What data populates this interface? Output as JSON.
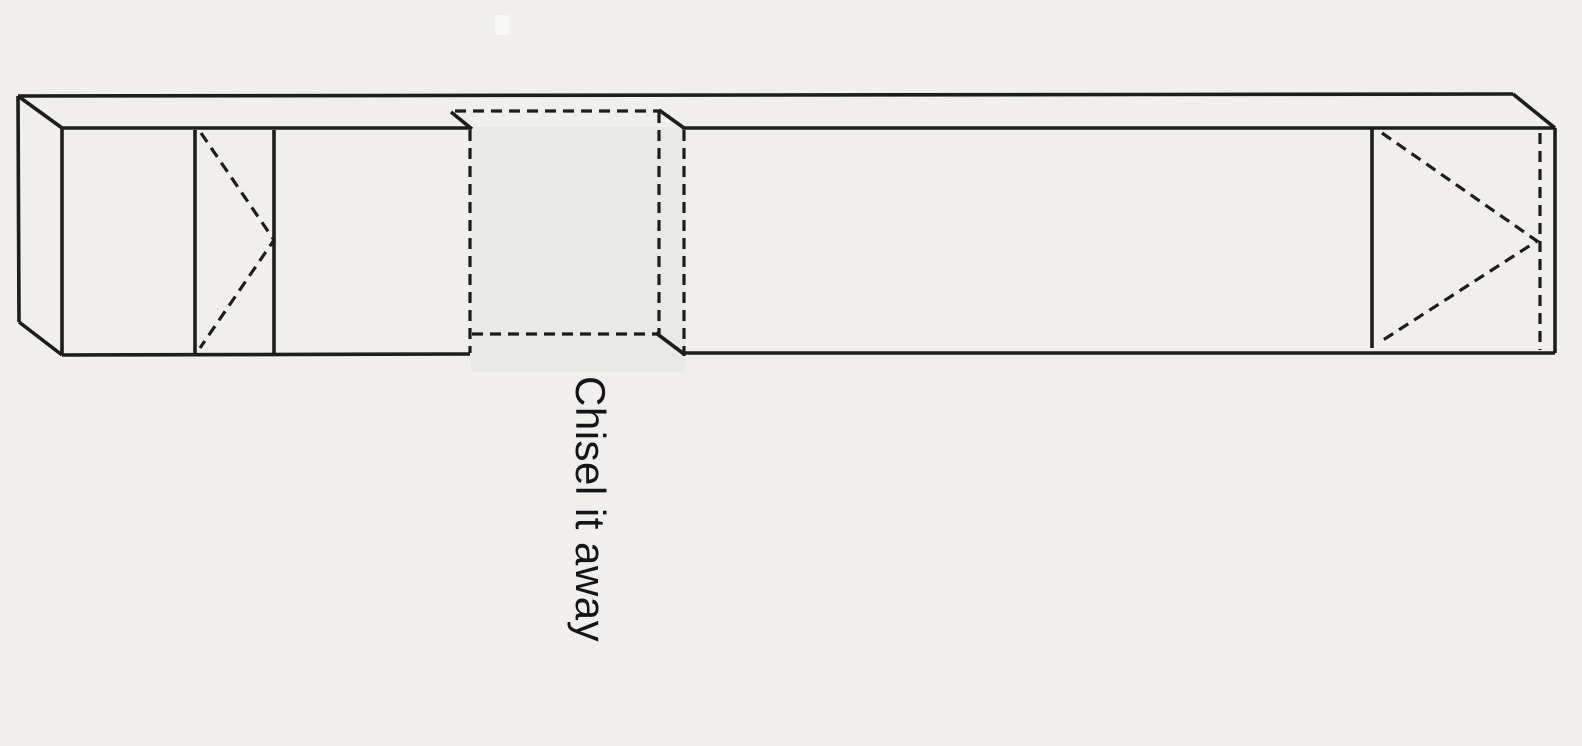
{
  "annotation": {
    "label": "Chisel it away",
    "orientation": "rotated-90-clockwise"
  },
  "colors": {
    "background": "#f0efed",
    "line": "#1d1d1b",
    "waste_fill": "#e9e9e7",
    "label_text": "#151515"
  },
  "diagram": {
    "kind": "woodworking joinery sketch",
    "parts": {
      "beam": "long rectangular timber drawn in perspective",
      "left_marks": "two scribed vertical lines with dashed V pointing right",
      "waste_notch": "dashed-outline notch section shaded gray across top and front faces",
      "right_marks": "scribed vertical line with dashed V pointing right and dashed end line"
    }
  }
}
